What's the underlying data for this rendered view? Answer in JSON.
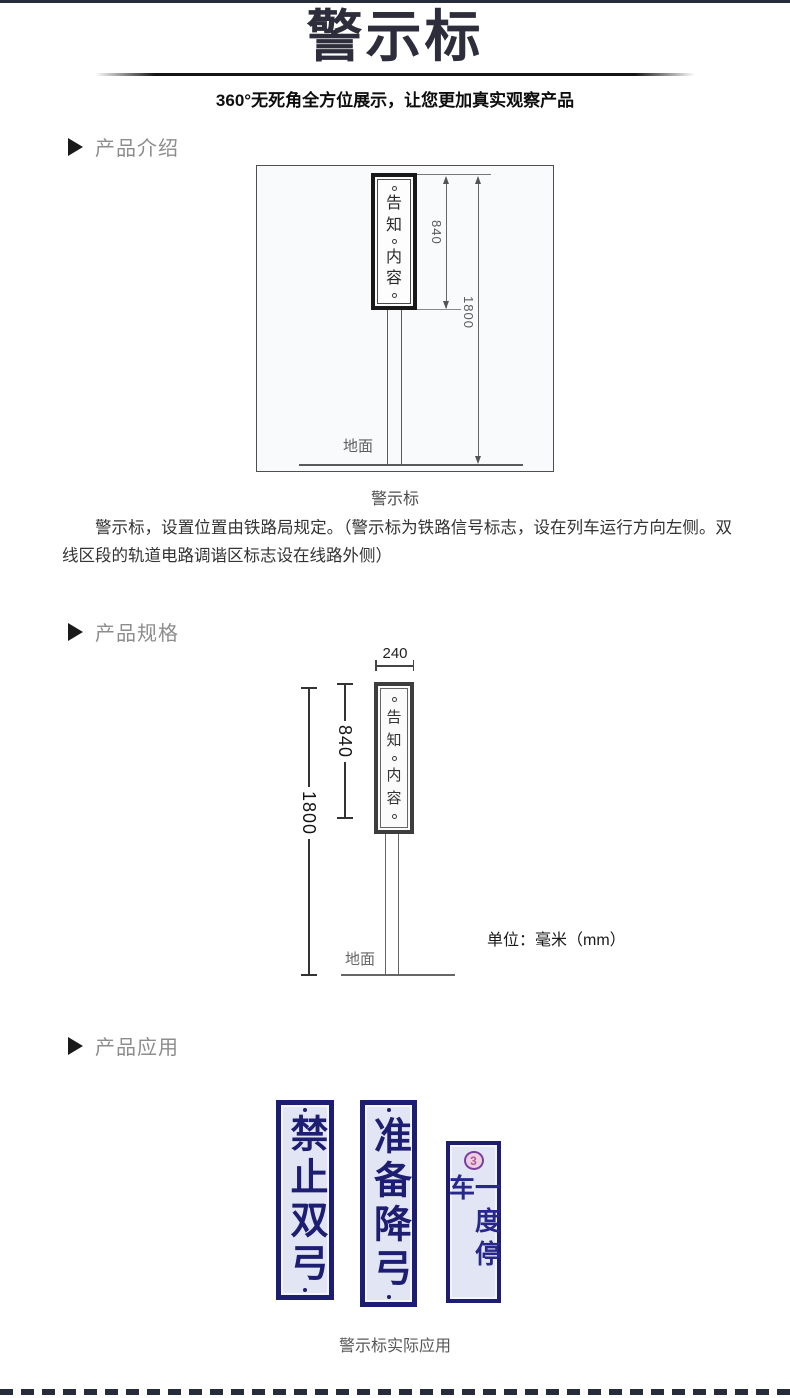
{
  "header": {
    "title": "警示标",
    "subtitle": "360°无死角全方位展示，让您更加真实观察产品"
  },
  "sections": {
    "intro": "产品介绍",
    "specs": "产品规格",
    "apps": "产品应用"
  },
  "intro": {
    "caption": "警示标",
    "paragraph": "警示标，设置位置由铁路局规定。（警示标为铁路信号标志，设在列车运行方向左侧。双线区段的轨道电路调谐区标志设在线路外侧）"
  },
  "diagram": {
    "sign_chars": [
      "告",
      "知",
      "内",
      "容"
    ],
    "width_mm": "240",
    "height_sign_mm": "840",
    "height_total_mm": "1800",
    "ground": "地面",
    "unit": "单位：毫米（mm）"
  },
  "applications": {
    "signs": [
      {
        "text": "禁止双弓"
      },
      {
        "text": "准备降弓"
      },
      {
        "text": "一度停车",
        "emblem": "3"
      }
    ],
    "caption": "警示标实际应用"
  },
  "colors": {
    "bar": "#272c3a",
    "sign_navy": "#1d1d72",
    "sign_bg": "#e2e5f3",
    "emblem_ring": "#7a3f9e",
    "emblem_bg": "#ecd0e2",
    "emblem_glyph": "#b05898"
  }
}
